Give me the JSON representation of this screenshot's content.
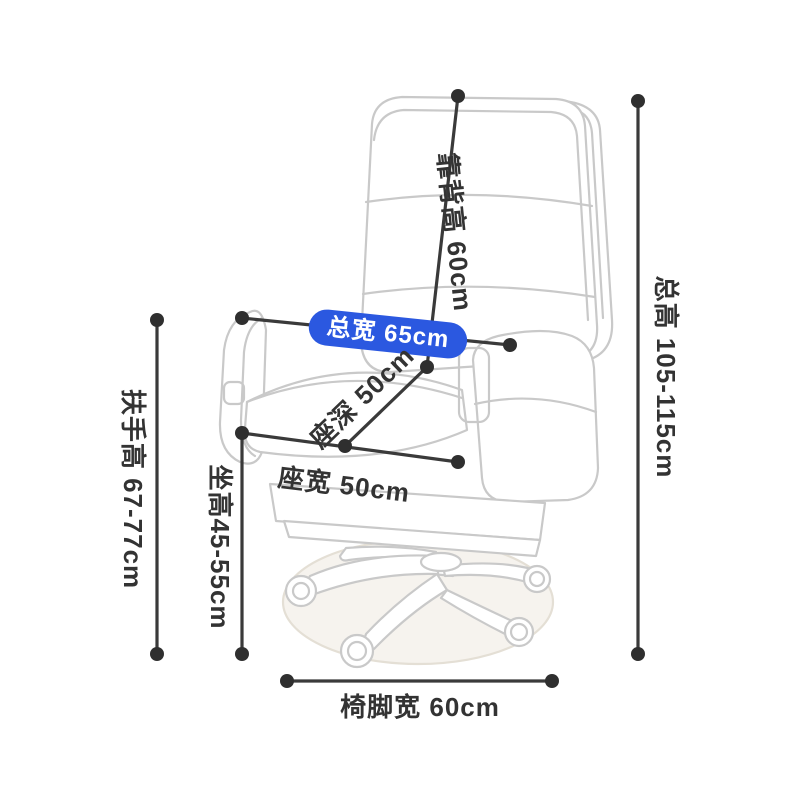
{
  "labels": {
    "backrest_height": "靠背高 60cm",
    "total_width": "总宽 65cm",
    "seat_depth": "座深 50cm",
    "seat_width": "座宽 50cm",
    "seat_height": "坐高45-55cm",
    "armrest_height": "扶手高 67-77cm",
    "total_height": "总高 105-115cm",
    "base_width": "椅脚宽 60cm"
  },
  "measurements": [
    {
      "part": "backrest-height",
      "label_cn": "靠背高",
      "value": "60cm"
    },
    {
      "part": "total-width",
      "label_cn": "总宽",
      "value": "65cm"
    },
    {
      "part": "seat-depth",
      "label_cn": "座深",
      "value": "50cm"
    },
    {
      "part": "seat-width",
      "label_cn": "座宽",
      "value": "50cm"
    },
    {
      "part": "seat-height",
      "label_cn": "坐高",
      "value": "45-55cm"
    },
    {
      "part": "armrest-height",
      "label_cn": "扶手高",
      "value": "67-77cm"
    },
    {
      "part": "total-height",
      "label_cn": "总高",
      "value": "105-115cm"
    },
    {
      "part": "base-width",
      "label_cn": "椅脚宽",
      "value": "60cm"
    }
  ],
  "colors": {
    "pill_bg": "#2b58e0",
    "pill_text": "#ffffff",
    "dimension_line": "#3a3a3a",
    "dimension_dot": "#2f2f2f",
    "label_text": "#333333",
    "chair_line": "#c9c9c9",
    "mat_fill": "#f6f3ee",
    "background": "#ffffff"
  }
}
